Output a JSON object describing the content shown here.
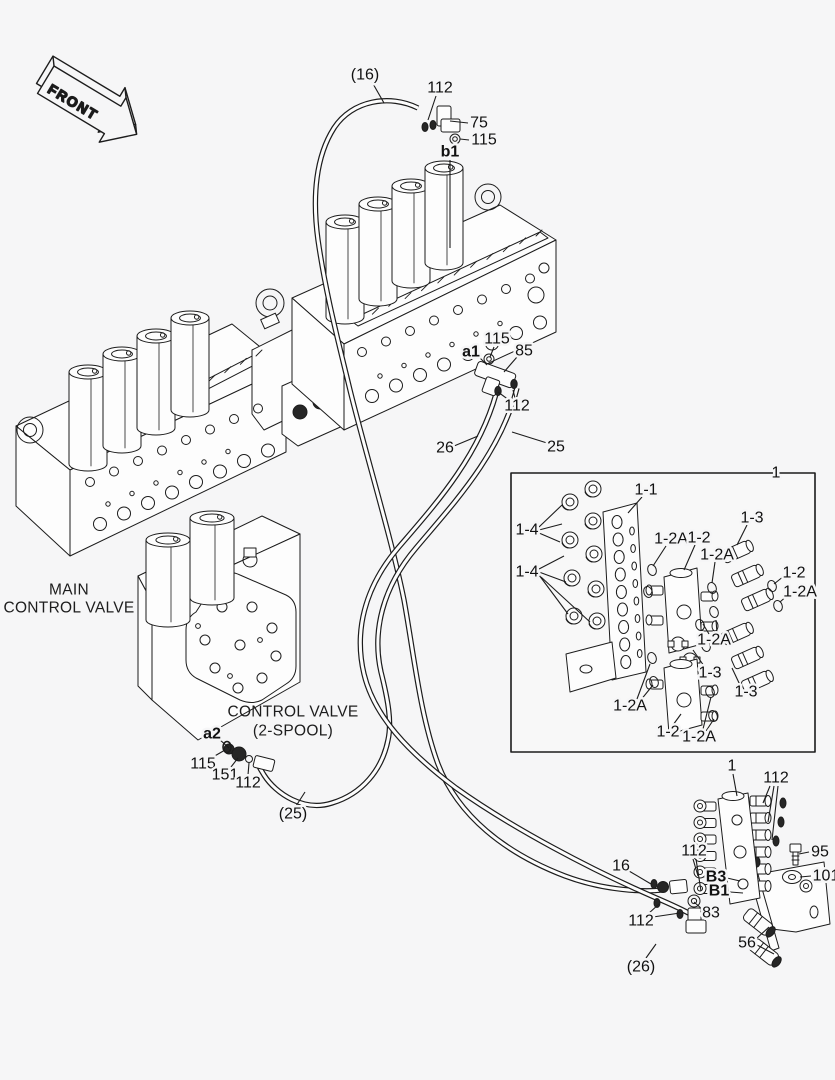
{
  "front_arrow": {
    "label": "FRONT"
  },
  "assembly_labels": {
    "main_valve": {
      "line1": "MAIN",
      "line2": "CONTROL VALVE"
    },
    "spool_valve": {
      "line1": "CONTROL VALVE",
      "line2": "(2-SPOOL)"
    }
  },
  "detail_box": {
    "label": "1"
  },
  "colors": {
    "line": "#1c1c1c",
    "background": "#f6f6f7",
    "text": "#111111"
  },
  "callouts": [
    {
      "text": "(16)",
      "x": 365,
      "y": 75,
      "leaders": [
        [
          372,
          82,
          384,
          103
        ]
      ]
    },
    {
      "text": "112",
      "x": 440,
      "y": 88,
      "leaders": [
        [
          436,
          96,
          428,
          120
        ]
      ]
    },
    {
      "text": "75",
      "x": 479,
      "y": 123,
      "leaders": [
        [
          468,
          123,
          450,
          121
        ]
      ]
    },
    {
      "text": "115",
      "x": 484,
      "y": 140,
      "leaders": [
        [
          469,
          140,
          460,
          139
        ]
      ]
    },
    {
      "text": "b1",
      "x": 450,
      "y": 152,
      "bold": true,
      "leaders": [
        [
          450,
          160,
          450,
          248
        ]
      ]
    },
    {
      "text": "115",
      "x": 497,
      "y": 339,
      "leaders": [
        [
          494,
          347,
          490,
          357
        ]
      ]
    },
    {
      "text": "a1",
      "x": 471,
      "y": 352,
      "bold": true,
      "leaders": [
        [
          479,
          357,
          487,
          365
        ]
      ]
    },
    {
      "text": "85",
      "x": 524,
      "y": 351,
      "leaders": [
        [
          517,
          357,
          504,
          372
        ]
      ]
    },
    {
      "text": "112",
      "x": 517,
      "y": 406,
      "leaders": [
        [
          509,
          400,
          498,
          392
        ],
        [
          515,
          398,
          513,
          390
        ]
      ]
    },
    {
      "text": "26",
      "x": 445,
      "y": 448,
      "leaders": [
        [
          454,
          446,
          478,
          436
        ]
      ]
    },
    {
      "text": "25",
      "x": 556,
      "y": 447,
      "leaders": [
        [
          547,
          443,
          512,
          432
        ]
      ]
    },
    {
      "text": "a2",
      "x": 212,
      "y": 734,
      "bold": true,
      "leaders": [
        [
          219,
          739,
          229,
          748
        ]
      ]
    },
    {
      "text": "115",
      "x": 203,
      "y": 764,
      "leaders": [
        [
          213,
          757,
          225,
          750
        ]
      ]
    },
    {
      "text": "151",
      "x": 225,
      "y": 775,
      "leaders": [
        [
          231,
          767,
          238,
          758
        ]
      ]
    },
    {
      "text": "112",
      "x": 248,
      "y": 783,
      "leaders": [
        [
          248,
          775,
          249,
          763
        ]
      ]
    },
    {
      "text": "(25)",
      "x": 293,
      "y": 814,
      "leaders": [
        [
          296,
          806,
          305,
          792
        ]
      ]
    },
    {
      "text": "1-1",
      "x": 646,
      "y": 490,
      "leaders": [
        [
          642,
          497,
          628,
          513
        ]
      ]
    },
    {
      "text": "1-4",
      "x": 527,
      "y": 530,
      "leaders": [
        [
          539,
          527,
          562,
          505
        ],
        [
          539,
          530,
          562,
          524
        ],
        [
          539,
          533,
          560,
          542
        ]
      ]
    },
    {
      "text": "1-4",
      "x": 527,
      "y": 572,
      "leaders": [
        [
          539,
          569,
          564,
          556
        ],
        [
          539,
          572,
          566,
          582
        ],
        [
          539,
          575,
          568,
          614
        ],
        [
          541,
          577,
          590,
          622
        ]
      ]
    },
    {
      "text": "1-2A",
      "x": 671,
      "y": 539,
      "leaders": [
        [
          666,
          546,
          653,
          566
        ]
      ]
    },
    {
      "text": "1-2",
      "x": 699,
      "y": 538,
      "leaders": [
        [
          695,
          545,
          684,
          570
        ]
      ]
    },
    {
      "text": "1-3",
      "x": 752,
      "y": 518,
      "leaders": [
        [
          747,
          525,
          737,
          545
        ]
      ]
    },
    {
      "text": "1-2A",
      "x": 717,
      "y": 555,
      "leaders": [
        [
          715,
          562,
          712,
          583
        ]
      ]
    },
    {
      "text": "1-2",
      "x": 794,
      "y": 573,
      "leaders": [
        [
          784,
          576,
          774,
          584
        ]
      ]
    },
    {
      "text": "1-2A",
      "x": 800,
      "y": 592,
      "leaders": [
        [
          789,
          594,
          780,
          602
        ]
      ]
    },
    {
      "text": "1-2A",
      "x": 714,
      "y": 640,
      "leaders": [
        [
          709,
          634,
          703,
          624
        ],
        [
          717,
          633,
          716,
          620
        ]
      ]
    },
    {
      "text": "1-3",
      "x": 710,
      "y": 673,
      "leaders": [
        [
          704,
          666,
          693,
          650
        ]
      ]
    },
    {
      "text": "1-3",
      "x": 746,
      "y": 692,
      "leaders": [
        [
          740,
          685,
          732,
          668
        ]
      ]
    },
    {
      "text": "1-2A",
      "x": 630,
      "y": 706,
      "leaders": [
        [
          637,
          699,
          650,
          664
        ],
        [
          640,
          701,
          653,
          685
        ]
      ]
    },
    {
      "text": "1-2",
      "x": 668,
      "y": 732,
      "leaders": [
        [
          673,
          725,
          681,
          714
        ]
      ]
    },
    {
      "text": "1-2A",
      "x": 699,
      "y": 737,
      "leaders": [
        [
          703,
          729,
          711,
          697
        ],
        [
          706,
          731,
          714,
          719
        ]
      ]
    },
    {
      "text": "1",
      "x": 776,
      "y": 473
    },
    {
      "text": "1",
      "x": 732,
      "y": 766,
      "leaders": [
        [
          733,
          774,
          737,
          796
        ]
      ]
    },
    {
      "text": "112",
      "x": 776,
      "y": 778,
      "leaders": [
        [
          770,
          786,
          763,
          803
        ],
        [
          774,
          786,
          768,
          822
        ],
        [
          778,
          786,
          772,
          840
        ]
      ]
    },
    {
      "text": "95",
      "x": 820,
      "y": 852,
      "leaders": [
        [
          809,
          852,
          799,
          854
        ]
      ]
    },
    {
      "text": "101",
      "x": 826,
      "y": 876,
      "leaders": [
        [
          811,
          876,
          800,
          877
        ]
      ]
    },
    {
      "text": "112",
      "x": 694,
      "y": 851,
      "leaders": [
        [
          693,
          859,
          698,
          876
        ],
        [
          696,
          859,
          701,
          891
        ]
      ]
    },
    {
      "text": "B3",
      "x": 716,
      "y": 877,
      "bold": true,
      "leaders": [
        [
          727,
          878,
          740,
          881
        ]
      ]
    },
    {
      "text": "B1",
      "x": 719,
      "y": 891,
      "bold": true,
      "leaders": [
        [
          730,
          892,
          743,
          893
        ]
      ]
    },
    {
      "text": "83",
      "x": 711,
      "y": 913,
      "leaders": [
        [
          702,
          909,
          694,
          902
        ]
      ]
    },
    {
      "text": "16",
      "x": 621,
      "y": 866,
      "leaders": [
        [
          629,
          871,
          651,
          884
        ]
      ]
    },
    {
      "text": "112",
      "x": 641,
      "y": 921,
      "leaders": [
        [
          648,
          914,
          659,
          904
        ],
        [
          653,
          917,
          680,
          913
        ]
      ]
    },
    {
      "text": "56",
      "x": 747,
      "y": 943,
      "leaders": [
        [
          756,
          939,
          769,
          927
        ],
        [
          757,
          945,
          774,
          954
        ]
      ]
    },
    {
      "text": "(26)",
      "x": 641,
      "y": 967,
      "leaders": [
        [
          646,
          958,
          656,
          944
        ]
      ]
    }
  ]
}
